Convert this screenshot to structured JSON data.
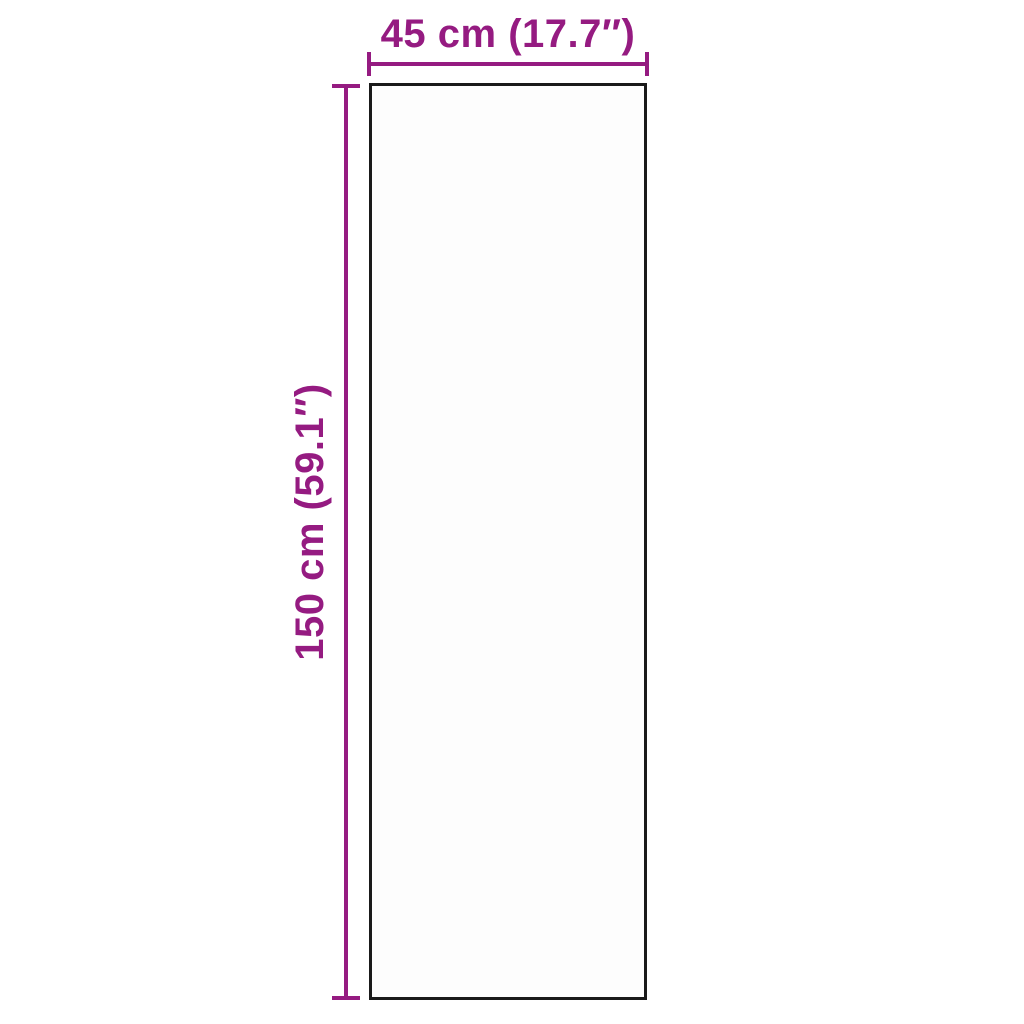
{
  "diagram": {
    "type": "product-dimension-diagram",
    "width_label": "45 cm (17.7″)",
    "height_label": "150 cm (59.1″)",
    "width_cm": 45,
    "width_inches": 17.7,
    "height_cm": 150,
    "height_inches": 59.1,
    "accent_color": "#951B81",
    "outline_color": "#1a1a1a",
    "background_color": "#ffffff"
  }
}
